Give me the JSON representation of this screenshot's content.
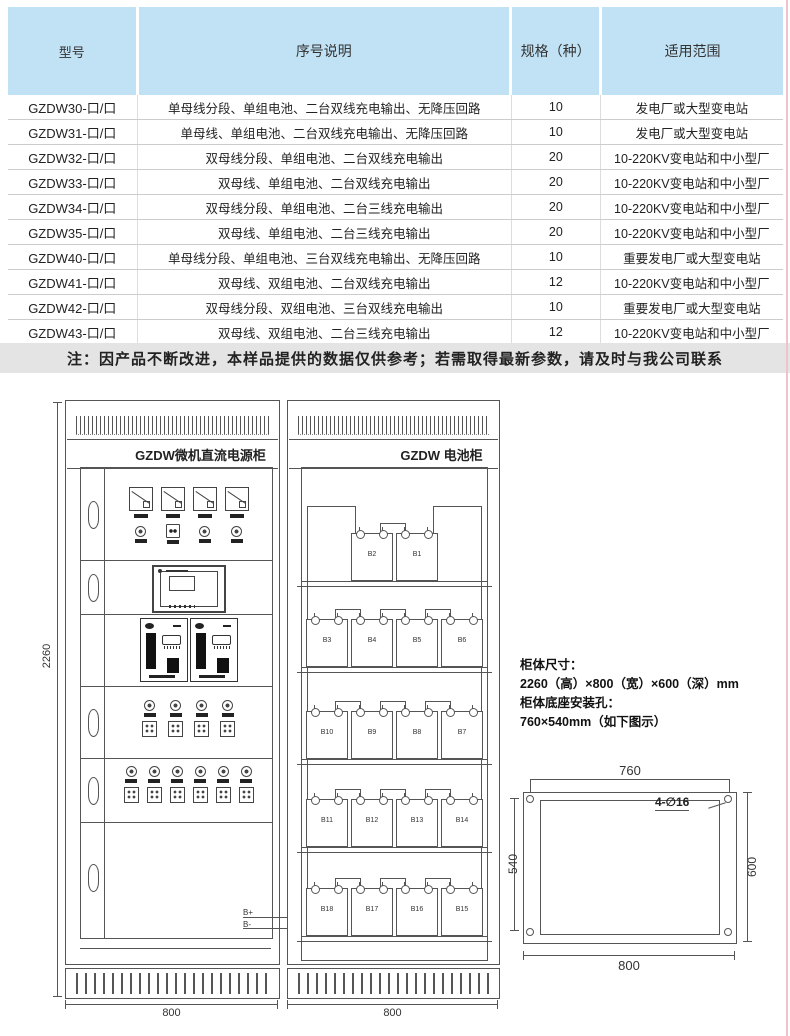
{
  "table": {
    "headers": [
      "型号",
      "序号说明",
      "规格（种）",
      "适用范围"
    ],
    "rows": [
      [
        "GZDW30-口/口",
        "单母线分段、单组电池、二台双线充电输出、无降压回路",
        "10",
        "发电厂或大型变电站"
      ],
      [
        "GZDW31-口/口",
        "单母线、单组电池、二台双线充电输出、无降压回路",
        "10",
        "发电厂或大型变电站"
      ],
      [
        "GZDW32-口/口",
        "双母线分段、单组电池、二台双线充电输出",
        "20",
        "10-220KV变电站和中小型厂"
      ],
      [
        "GZDW33-口/口",
        "双母线、单组电池、二台双线充电输出",
        "20",
        "10-220KV变电站和中小型厂"
      ],
      [
        "GZDW34-口/口",
        "双母线分段、单组电池、二台三线充电输出",
        "20",
        "10-220KV变电站和中小型厂"
      ],
      [
        "GZDW35-口/口",
        "双母线、单组电池、二台三线充电输出",
        "20",
        "10-220KV变电站和中小型厂"
      ],
      [
        "GZDW40-口/口",
        "单母线分段、单组电池、三台双线充电输出、无降压回路",
        "10",
        "重要发电厂或大型变电站"
      ],
      [
        "GZDW41-口/口",
        "双母线、双组电池、二台双线充电输出",
        "12",
        "10-220KV变电站和中小型厂"
      ],
      [
        "GZDW42-口/口",
        "双母线分段、双组电池、三台双线充电输出",
        "10",
        "重要发电厂或大型变电站"
      ],
      [
        "GZDW43-口/口",
        "双母线、双组电池、二台三线充电输出",
        "12",
        "10-220KV变电站和中小型厂"
      ]
    ]
  },
  "note": "注：因产品不断改进，本样品提供的数据仅供参考；若需取得最新参数，请及时与我公司联系",
  "diagram": {
    "power_cabinet": {
      "title": "GZDW微机直流电源柜",
      "height_label": "2260",
      "width_label": "800",
      "bplus": "B+",
      "bminus": "B-"
    },
    "battery_cabinet": {
      "title": "GZDW 电池柜",
      "width_label": "800",
      "shelves": [
        [
          "B2",
          "B1"
        ],
        [
          "B3",
          "B4",
          "B5",
          "B6"
        ],
        [
          "B10",
          "B9",
          "B8",
          "B7"
        ],
        [
          "B11",
          "B12",
          "B13",
          "B14"
        ],
        [
          "B18",
          "B17",
          "B16",
          "B15"
        ]
      ]
    },
    "specs": [
      "柜体尺寸：",
      "2260（高）×800（宽）×600（深）mm",
      "柜体底座安装孔：",
      "760×540mm（如下图示）"
    ],
    "mounting": {
      "top_dim": "760",
      "left_dim": "540",
      "right_dim": "600",
      "bottom_dim": "800",
      "holes_label": "4-∅16"
    }
  },
  "colors": {
    "header_bg": "#c0e2f4",
    "note_bg": "#e4e4e4",
    "line": "#555555",
    "accent_pink": "#eec3cc"
  }
}
